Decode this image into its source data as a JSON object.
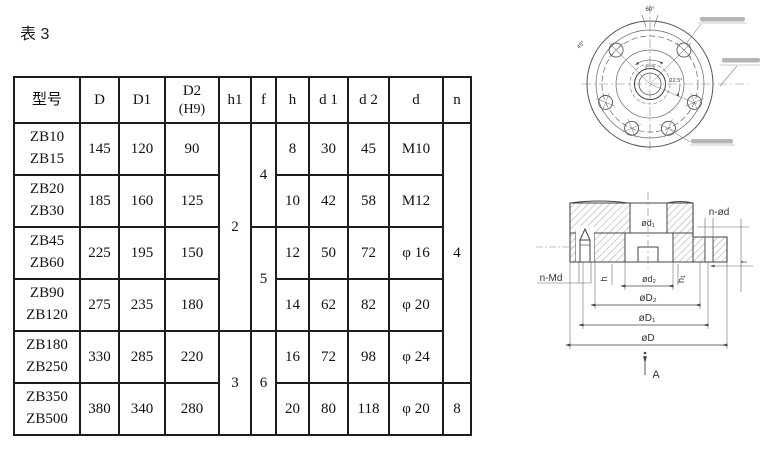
{
  "title": "表 3",
  "table": {
    "headers": {
      "model": "型号",
      "D": "D",
      "D1": "D1",
      "D2": "D2",
      "D2_sub": "(H9)",
      "h1": "h1",
      "f": "f",
      "h": "h",
      "d1": "d 1",
      "d2": "d 2",
      "d": "d",
      "n": "n"
    },
    "rows": [
      {
        "m1": "ZB10",
        "m2": "ZB15",
        "D": "145",
        "D1": "120",
        "D2": "90",
        "h": "8",
        "d1": "30",
        "d2": "45",
        "d": "M10"
      },
      {
        "m1": "ZB20",
        "m2": "ZB30",
        "D": "185",
        "D1": "160",
        "D2": "125",
        "h": "10",
        "d1": "42",
        "d2": "58",
        "d": "M12"
      },
      {
        "m1": "ZB45",
        "m2": "ZB60",
        "D": "225",
        "D1": "195",
        "D2": "150",
        "h": "12",
        "d1": "50",
        "d2": "72",
        "d": "φ 16"
      },
      {
        "m1": "ZB90",
        "m2": "ZB120",
        "D": "275",
        "D1": "235",
        "D2": "180",
        "h": "14",
        "d1": "62",
        "d2": "82",
        "d": "φ 20"
      },
      {
        "m1": "ZB180",
        "m2": "ZB250",
        "D": "330",
        "D1": "285",
        "D2": "220",
        "h": "16",
        "d1": "72",
        "d2": "98",
        "d": "φ 24"
      },
      {
        "m1": "ZB350",
        "m2": "ZB500",
        "D": "380",
        "D1": "340",
        "D2": "280",
        "h": "20",
        "d1": "80",
        "d2": "118",
        "d": "φ 20"
      }
    ],
    "merged": {
      "h1_a": "2",
      "h1_b": "3",
      "f_a": "4",
      "f_b": "5",
      "f_c": "6",
      "n_a": "4",
      "n_b": "8"
    }
  },
  "drawings": {
    "top": {
      "angle_top": "60°",
      "angle_right": "22.5°",
      "angle_left": "45°"
    },
    "section": {
      "d1": "ød₁",
      "nOd": "n-ød",
      "nMd": "n-Md",
      "h": "h",
      "d2": "ød₂",
      "h1": "h₁",
      "D2": "øD₂",
      "D1": "øD₁",
      "D": "øD",
      "f": "f",
      "view": "A"
    }
  }
}
